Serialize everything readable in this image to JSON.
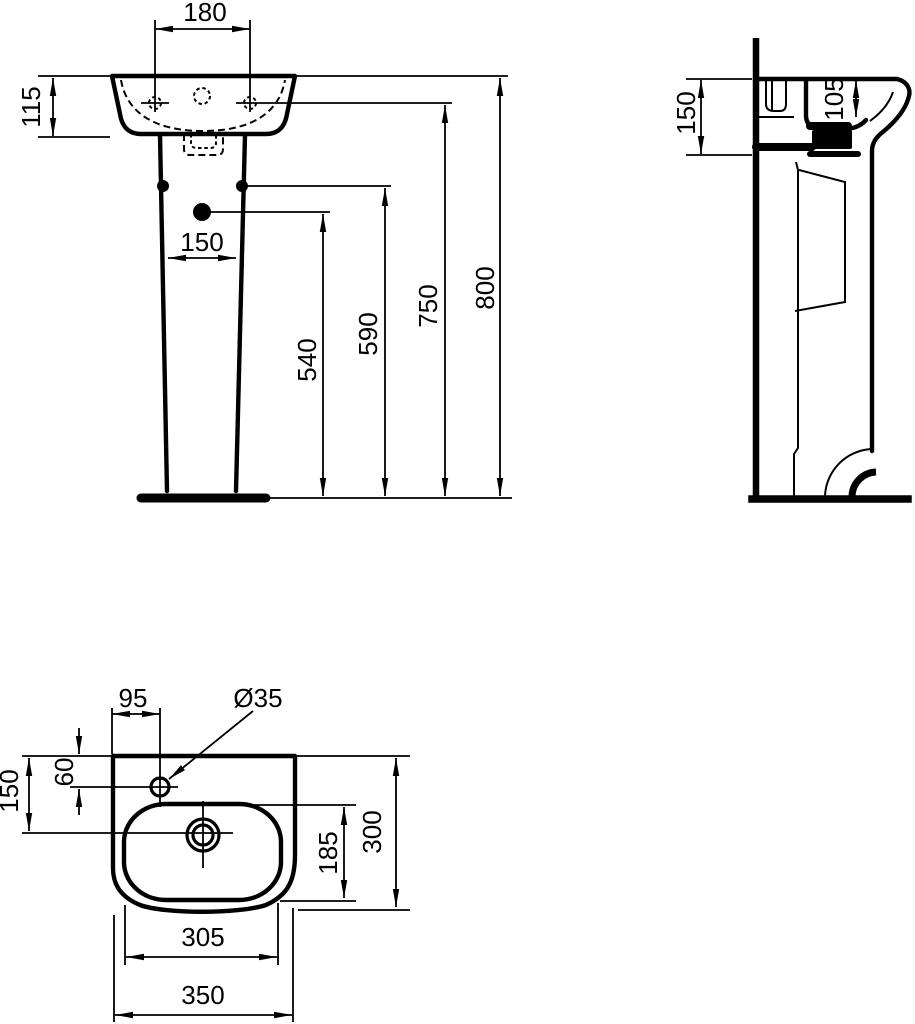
{
  "front_view": {
    "hole_spacing": "180",
    "basin_front_height": "115",
    "pedestal_width": "150",
    "height_to_drain": "540",
    "height_to_fixing": "590",
    "height_to_holes": "750",
    "total_height": "800"
  },
  "side_view": {
    "basin_height": "150",
    "bowl_depth": "105"
  },
  "plan_view": {
    "tap_hole_offset": "95",
    "tap_hole_diameter": "Ø35",
    "back_to_drain": "150",
    "tap_hole_from_back": "60",
    "bowl_depth": "185",
    "total_depth": "300",
    "bowl_width": "305",
    "total_width": "350"
  },
  "colors": {
    "line": "#000000",
    "background": "#ffffff"
  }
}
